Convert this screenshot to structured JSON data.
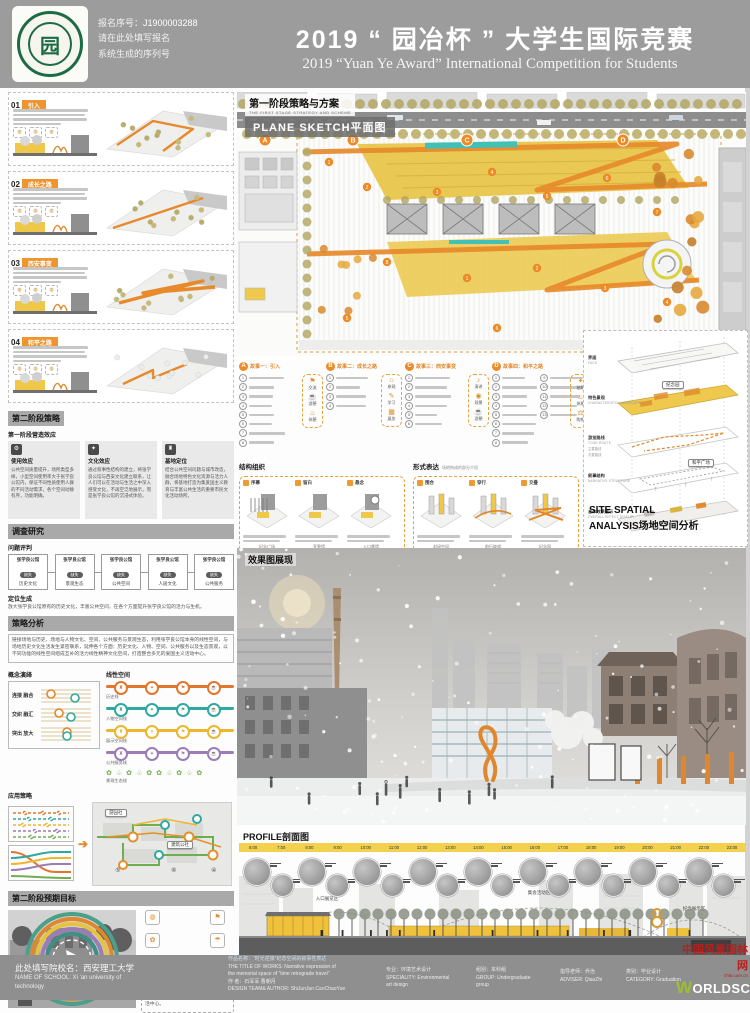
{
  "colors": {
    "accent": "#ee8a25",
    "yellow": "#eec94d",
    "teal": "#3fb8ae",
    "purple": "#9b7cb6",
    "green": "#6fae4e",
    "olive": "#b5a967",
    "band_gray": "#9c9c9c"
  },
  "header": {
    "serial_label": "报名序号：",
    "serial_number": "J1900003288",
    "serial_line2": "请在此处填写报名",
    "serial_line3": "系统生成的序列号",
    "title": "2019 “ 园冶杯 ” 大学生国际竞赛",
    "subtitle": "2019 “Yuan Ye Award” International Competition for  Students"
  },
  "left": {
    "story_panels": [
      {
        "num": "01",
        "title": "引入"
      },
      {
        "num": "02",
        "title": "成长之路"
      },
      {
        "num": "03",
        "title": "西安事变"
      },
      {
        "num": "04",
        "title": "和平之路"
      }
    ],
    "stage2_title": "第二阶段策略",
    "effect_title": "第一阶段营造效应",
    "cards": [
      {
        "icon_glyph": "⚙",
        "icon_name": "usage-icon",
        "title": "使用效应",
        "text": "公共空间质量提升，场所类型多样，小型空间使用率大于张学良公馆内，保证不同性质使用人群的不同活动需求，各个空间动静有序，功能明确。"
      },
      {
        "icon_glyph": "✦",
        "icon_name": "culture-icon",
        "title": "文化效应",
        "text": "通过叙事性结构的建立，将张学良公馆与西安文化建立联系，让人们可以在活动与生活之中深入感受文化，不再空泛地展示，而是张学良公馆的沉浸式体验。"
      },
      {
        "icon_glyph": "♜",
        "icon_name": "site-icon",
        "title": "基地定位",
        "text": "结合公共空间问题与城市改造，融合场地特色文化资源与活力人群，将基地打造为集爱国主义教育与丰富公共生活的重要市民文化活动场所。"
      }
    ],
    "survey_bar": "调查研究",
    "survey_sub": "问题评判",
    "survey_node": "张学良公馆",
    "survey_tag": "缺失",
    "survey_aspects": [
      "历史文化",
      "景观生态",
      "公共空间",
      "人居文化",
      "公共服务"
    ],
    "positioning_sub": "定位生成",
    "positioning_text": "放大张学良公馆原有的历史文化，丰富公共空间，在各个方面提升张学良公馆的活力与生机。",
    "strategy_bar": "策略分析",
    "strategy_text": "链接场地与历史、场地与人物文化、空间、公共服务与景观生态，利用张学良公馆本身的线性空间，与场地历史文化生活发生紧密联系，延伸各个方面：历史文化、人物、空间、公共服务以及生态景观，以不同功能的线性空间组成互补的活力线性精神文化空间，打造整合多元的爱国主义活动中心。",
    "concept_sub": "概念演绎",
    "concept_items": [
      "连接 融合",
      "交织 融汇",
      "突出 放大"
    ],
    "linear_sub": "线性空间",
    "linear_lines": [
      {
        "label": "历史线",
        "color": "#e1762c"
      },
      {
        "label": "人物空间线",
        "color": "#2fa8a0"
      },
      {
        "label": "展示空间线",
        "color": "#eeb52f"
      },
      {
        "label": "公共服务线",
        "color": "#9b7cb6"
      },
      {
        "label": "景观生态线",
        "color": "#6fae4e"
      }
    ],
    "apply_sub": "应用策略",
    "apply_callouts": [
      "游园社",
      "建筑公社"
    ],
    "apply_nums": [
      "⑤",
      "⑥",
      "④"
    ],
    "target_bar": "第二阶段预期目标",
    "target_text": "张学良公馆红色教育基地建设发展成熟，园区文化的发展扩大了基地的影响力，历史文化融入了丰富多样的公共生活中心。",
    "target_icons": [
      {
        "name": "signal-icon",
        "glyph": "◍"
      },
      {
        "name": "flag-icon",
        "glyph": "⚑"
      },
      {
        "name": "plant-icon",
        "glyph": "✿"
      },
      {
        "name": "bell-icon",
        "glyph": "☂"
      },
      {
        "name": "camera-icon",
        "glyph": "✦"
      },
      {
        "name": "museum-icon",
        "glyph": "♜"
      }
    ]
  },
  "plan": {
    "title": "第一阶段策略与方案",
    "title_en": "THE FIRST STAGE STRATEGY AND SCHEME",
    "sketch_label": "PLANE SKETCH平面图",
    "markers": [
      "A",
      "B",
      "C",
      "D"
    ]
  },
  "stories": [
    {
      "marker": "A",
      "title": "故事一：引入",
      "count": 8,
      "icons": [
        {
          "name": "chat-icon",
          "glyph": "⚑",
          "label": "交流"
        },
        {
          "name": "stroll-icon",
          "glyph": "☕",
          "label": "游憩"
        },
        {
          "name": "rest-icon",
          "glyph": "♨",
          "label": "休憩"
        }
      ]
    },
    {
      "marker": "B",
      "title": "故事二：成长之路",
      "count": 4,
      "icons": [
        {
          "name": "visit-icon",
          "glyph": "⌂",
          "label": "参观"
        },
        {
          "name": "study-icon",
          "glyph": "✎",
          "label": "学习"
        },
        {
          "name": "exhibit-icon",
          "glyph": "▦",
          "label": "展览"
        }
      ]
    },
    {
      "marker": "C",
      "title": "故事三：西安事变",
      "count": 6,
      "icons": [
        {
          "name": "speech-icon",
          "glyph": "♪",
          "label": "演讲"
        },
        {
          "name": "view-icon",
          "glyph": "◉",
          "label": "观景"
        },
        {
          "name": "leisure-icon",
          "glyph": "☕",
          "label": "游憩"
        }
      ]
    },
    {
      "marker": "D",
      "title": "故事四：和平之路",
      "count": 13,
      "icons": [
        {
          "name": "photo-icon",
          "glyph": "✦",
          "label": "拍照"
        },
        {
          "name": "rest2-icon",
          "glyph": "♨",
          "label": "休憩"
        },
        {
          "name": "shop-icon",
          "glyph": "⚖",
          "label": "购物"
        }
      ]
    }
  ],
  "structure": {
    "title": "结构组织",
    "boxes": [
      {
        "tag": "序幕",
        "label": "纪念广场"
      },
      {
        "tag": "留白",
        "label": "宣誓墙"
      },
      {
        "tag": "悬念",
        "label": "入口景墙"
      }
    ]
  },
  "form": {
    "title": "形式表达",
    "note": "场地构成的部分介绍",
    "boxes": [
      {
        "tag": "围合",
        "label": "封闭空间"
      },
      {
        "tag": "穿行",
        "label": "前行坡道"
      },
      {
        "tag": "交叠",
        "label": "纪念园"
      }
    ]
  },
  "site_analysis": {
    "layers": [
      {
        "cn": "界面",
        "en": "FACE"
      },
      {
        "cn": "特色景观",
        "en": "CHARACTERISTIC LANDSCAPE"
      },
      {
        "cn": "游览路线",
        "en": "TOUR ROUTE"
      },
      {
        "cn": "叙事结构",
        "en": "NARRATIVE STRUCTURE"
      },
      {
        "cn": "总体效果展示",
        "en": "OVERALL EFFECT DISPLAY"
      }
    ],
    "routes": [
      "主要路线",
      "次要路线"
    ],
    "callouts": [
      "纪念园",
      "和平广场"
    ],
    "title_line1": "SITE SPATIAL",
    "title_line2": "ANALYSIS场地空间分析"
  },
  "render": {
    "title": "效果图展现"
  },
  "profile": {
    "title": "PROFILE剖面图",
    "hours": [
      "6:00",
      "7:00",
      "8:00",
      "9:00",
      "10:00",
      "11:00",
      "12:00",
      "13:00",
      "14:00",
      "15:00",
      "16:00",
      "17:00",
      "18:00",
      "19:00",
      "20:00",
      "21:00",
      "22:00",
      "23:00"
    ],
    "arcs": [
      "入口展览区",
      "集会活动区",
      "纪念展示区"
    ]
  },
  "footer": {
    "school_cn": "此处填写院校名：西安理工大学",
    "school_en1": "NAME OF SCHOOL: Xi 'an university of",
    "school_en2": "technology",
    "work_title_cn": "作品名称：“时光逆旅”纪念空间的叙事性表达",
    "work_title_en1": "THE TITLE OF WORKS: Narrative expression of",
    "work_title_en2": "the memorial space of “time retrograde travel”",
    "author_cn": "作    者：石军军  曹朝月",
    "author_en": "DESIGN TEAM& AUTHOR: ShiJunJun  CaoChaoYue",
    "specialty_cn": "专业：环境艺术设计",
    "specialty_en1": "SPECIALITY: Environmental",
    "specialty_en2": "art design",
    "group_cn": "组别：本科组",
    "group_en1": "GROUP: Undergraduate",
    "group_en2": "group",
    "adviser_cn": "指导老师：乔治",
    "adviser_en": "ADVISER: QiaoZhi",
    "category_cn": "类别：毕业设计",
    "category_en": "CATEGORY: Graduation",
    "logo_cn": "中国风景园林网",
    "logo_url": "chla.com.cn",
    "logo_world_w": "W",
    "logo_world_rest": "ORLDSCAPE"
  }
}
